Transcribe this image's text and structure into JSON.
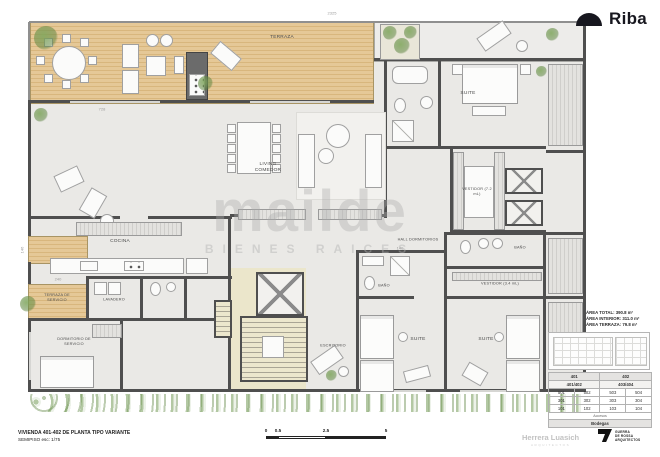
{
  "branding": {
    "riba": "Riba",
    "watermark_line1": "mailde",
    "watermark_line2": "BIENES RAICES",
    "herrera_name": "Herrera Luasich",
    "herrera_sub": "ARQUITECTOS",
    "guerra_lines": [
      "GUERRA",
      "DE ROSSA",
      "ARQUITECTOS"
    ]
  },
  "title_block": {
    "line1": "VIVIENDA 401-402 DE PLANTA TIPO VARIANTE",
    "line2": "SEMIPISO esc: 1/75"
  },
  "scale_bar": {
    "labels": [
      "0",
      "0.5",
      "2.5",
      "5"
    ]
  },
  "area_info": {
    "line1": "ÁREA TOTAL: 390.8 m²",
    "line2": "ÁREA INTERIOR: 311.0 m²",
    "line3": "ÁREA TERRAZA: 79.8 m²"
  },
  "stack_table": {
    "header": [
      "401",
      "402"
    ],
    "subheader": [
      "401/402",
      "403/404"
    ],
    "rows": [
      [
        "501",
        "502",
        "503",
        "504"
      ],
      [
        "301",
        "302",
        "303",
        "304"
      ],
      [
        "101",
        "102",
        "103",
        "104"
      ]
    ],
    "footer": [
      "Accesos",
      "Bodegas"
    ]
  },
  "plan": {
    "labels": {
      "terraza": "TERRAZA",
      "living": "LIVING COMEDOR",
      "cocina": "COCINA",
      "lavadero": "LAVADERO",
      "terraza_servicio": "TERRAZA DE SERVICIO",
      "dormitorio_servicio": "DORMITORIO DE SERVICIO",
      "escritorio": "ESCRITORIO",
      "suite_principal": "SUITE",
      "vestidor_principal": "VESTIDOR (7.2 mL)",
      "hall": "HALL DORMITORIOS",
      "bano1": "BAÑO",
      "bano2": "BAÑO",
      "vestidor2": "VESTIDOR (3.4 mL)",
      "suite2": "SUITE",
      "suite3": "SUITE"
    },
    "dimensions": {
      "top": "2325",
      "living": "728",
      "left": "146",
      "service": "240",
      "bath": "140"
    }
  },
  "colors": {
    "wall": "#4f4f4f",
    "wood_deck": "#e0c18d",
    "interior_floor": "#eae9e6",
    "core_fill": "#ebe6cb",
    "greenery": "#6f9e53",
    "logo_dark": "#17171f",
    "watermark_gray": "#bdbdbd"
  }
}
